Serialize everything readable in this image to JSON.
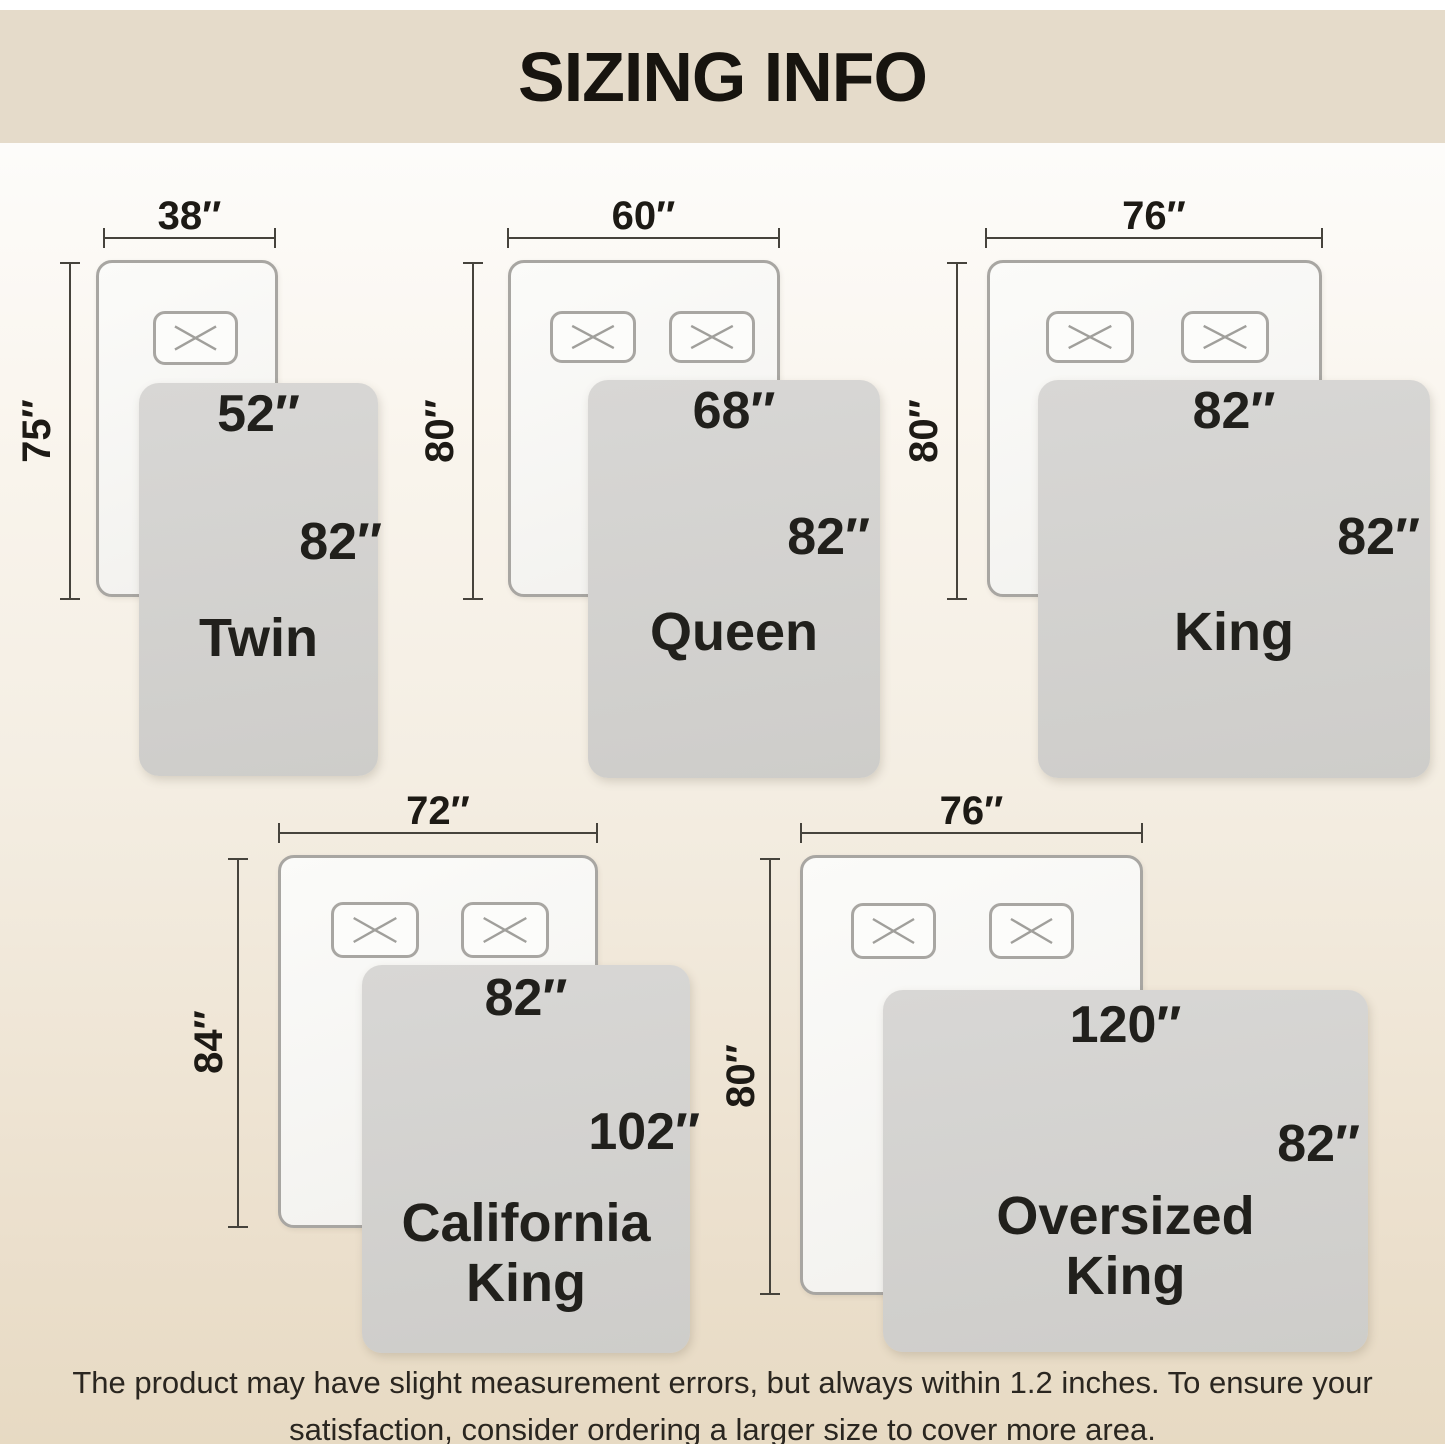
{
  "title": "SIZING INFO",
  "colors": {
    "header-bg": "#e5dbca",
    "outline": "#a8a6a2",
    "dim-line": "#46433c",
    "text": "#1d1a15",
    "blanket-text": "#21201c"
  },
  "sizes": [
    {
      "name": "Twin",
      "name_lines": [
        "Twin"
      ],
      "mattress_width": "38″",
      "mattress_length": "75″",
      "blanket_width": "52″",
      "blanket_length": "82″",
      "pillows": 1
    },
    {
      "name": "Queen",
      "name_lines": [
        "Queen"
      ],
      "mattress_width": "60″",
      "mattress_length": "80″",
      "blanket_width": "68″",
      "blanket_length": "82″",
      "pillows": 2
    },
    {
      "name": "King",
      "name_lines": [
        "King"
      ],
      "mattress_width": "76″",
      "mattress_length": "80″",
      "blanket_width": "82″",
      "blanket_length": "82″",
      "pillows": 2
    },
    {
      "name": "California King",
      "name_lines": [
        "California",
        "King"
      ],
      "mattress_width": "72″",
      "mattress_length": "84″",
      "blanket_width": "82″",
      "blanket_length": "102″",
      "pillows": 2
    },
    {
      "name": "Oversized King",
      "name_lines": [
        "Oversized",
        "King"
      ],
      "mattress_width": "76″",
      "mattress_length": "80″",
      "blanket_width": "120″",
      "blanket_length": "82″",
      "pillows": 2
    }
  ],
  "footer_lines": [
    "The product may have slight measurement errors, but always within 1.2 inches. To ensure your",
    "satisfaction, consider ordering a larger size to cover more area."
  ]
}
